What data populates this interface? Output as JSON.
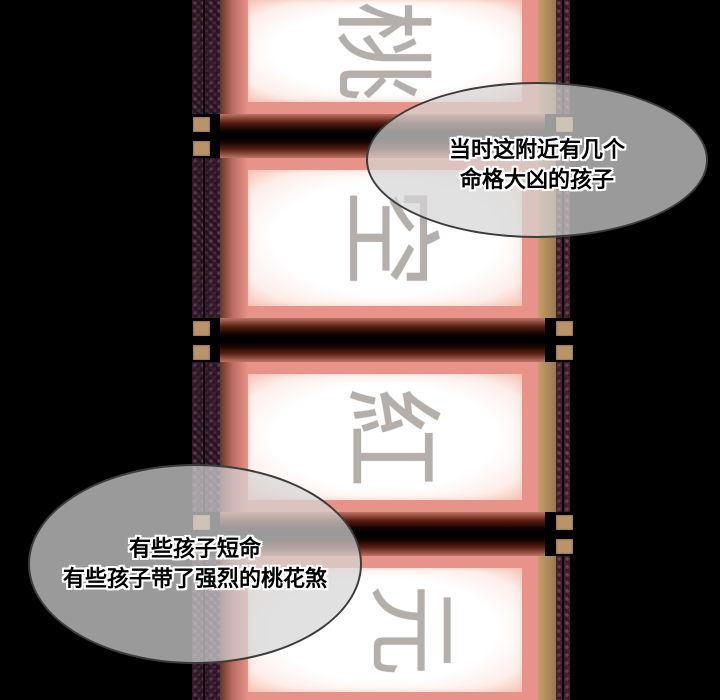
{
  "comic": {
    "panels": [
      {
        "char": "桃"
      },
      {
        "char": "空"
      },
      {
        "char": "紅"
      },
      {
        "char": "元"
      }
    ],
    "bubbles": [
      {
        "lines": [
          "当时这附近有几个",
          "命格大凶的孩子"
        ]
      },
      {
        "lines": [
          "有些孩子短命",
          "有些孩子带了强烈的桃花煞"
        ]
      }
    ],
    "colors": {
      "background": "#000000",
      "mat_salmon": "#e8938a",
      "paper_white": "#ffffff",
      "border_purple_left": "#261320",
      "border_purple_right": "#341b28",
      "tan_strip": "#ad8a5c",
      "knob_tan": "#b9946a",
      "glyph_gray": "#b5afac",
      "bubble_fill": "rgba(214,214,214,0.72)",
      "bubble_border": "#3c3c3c",
      "bubble_text": "#000000"
    }
  }
}
